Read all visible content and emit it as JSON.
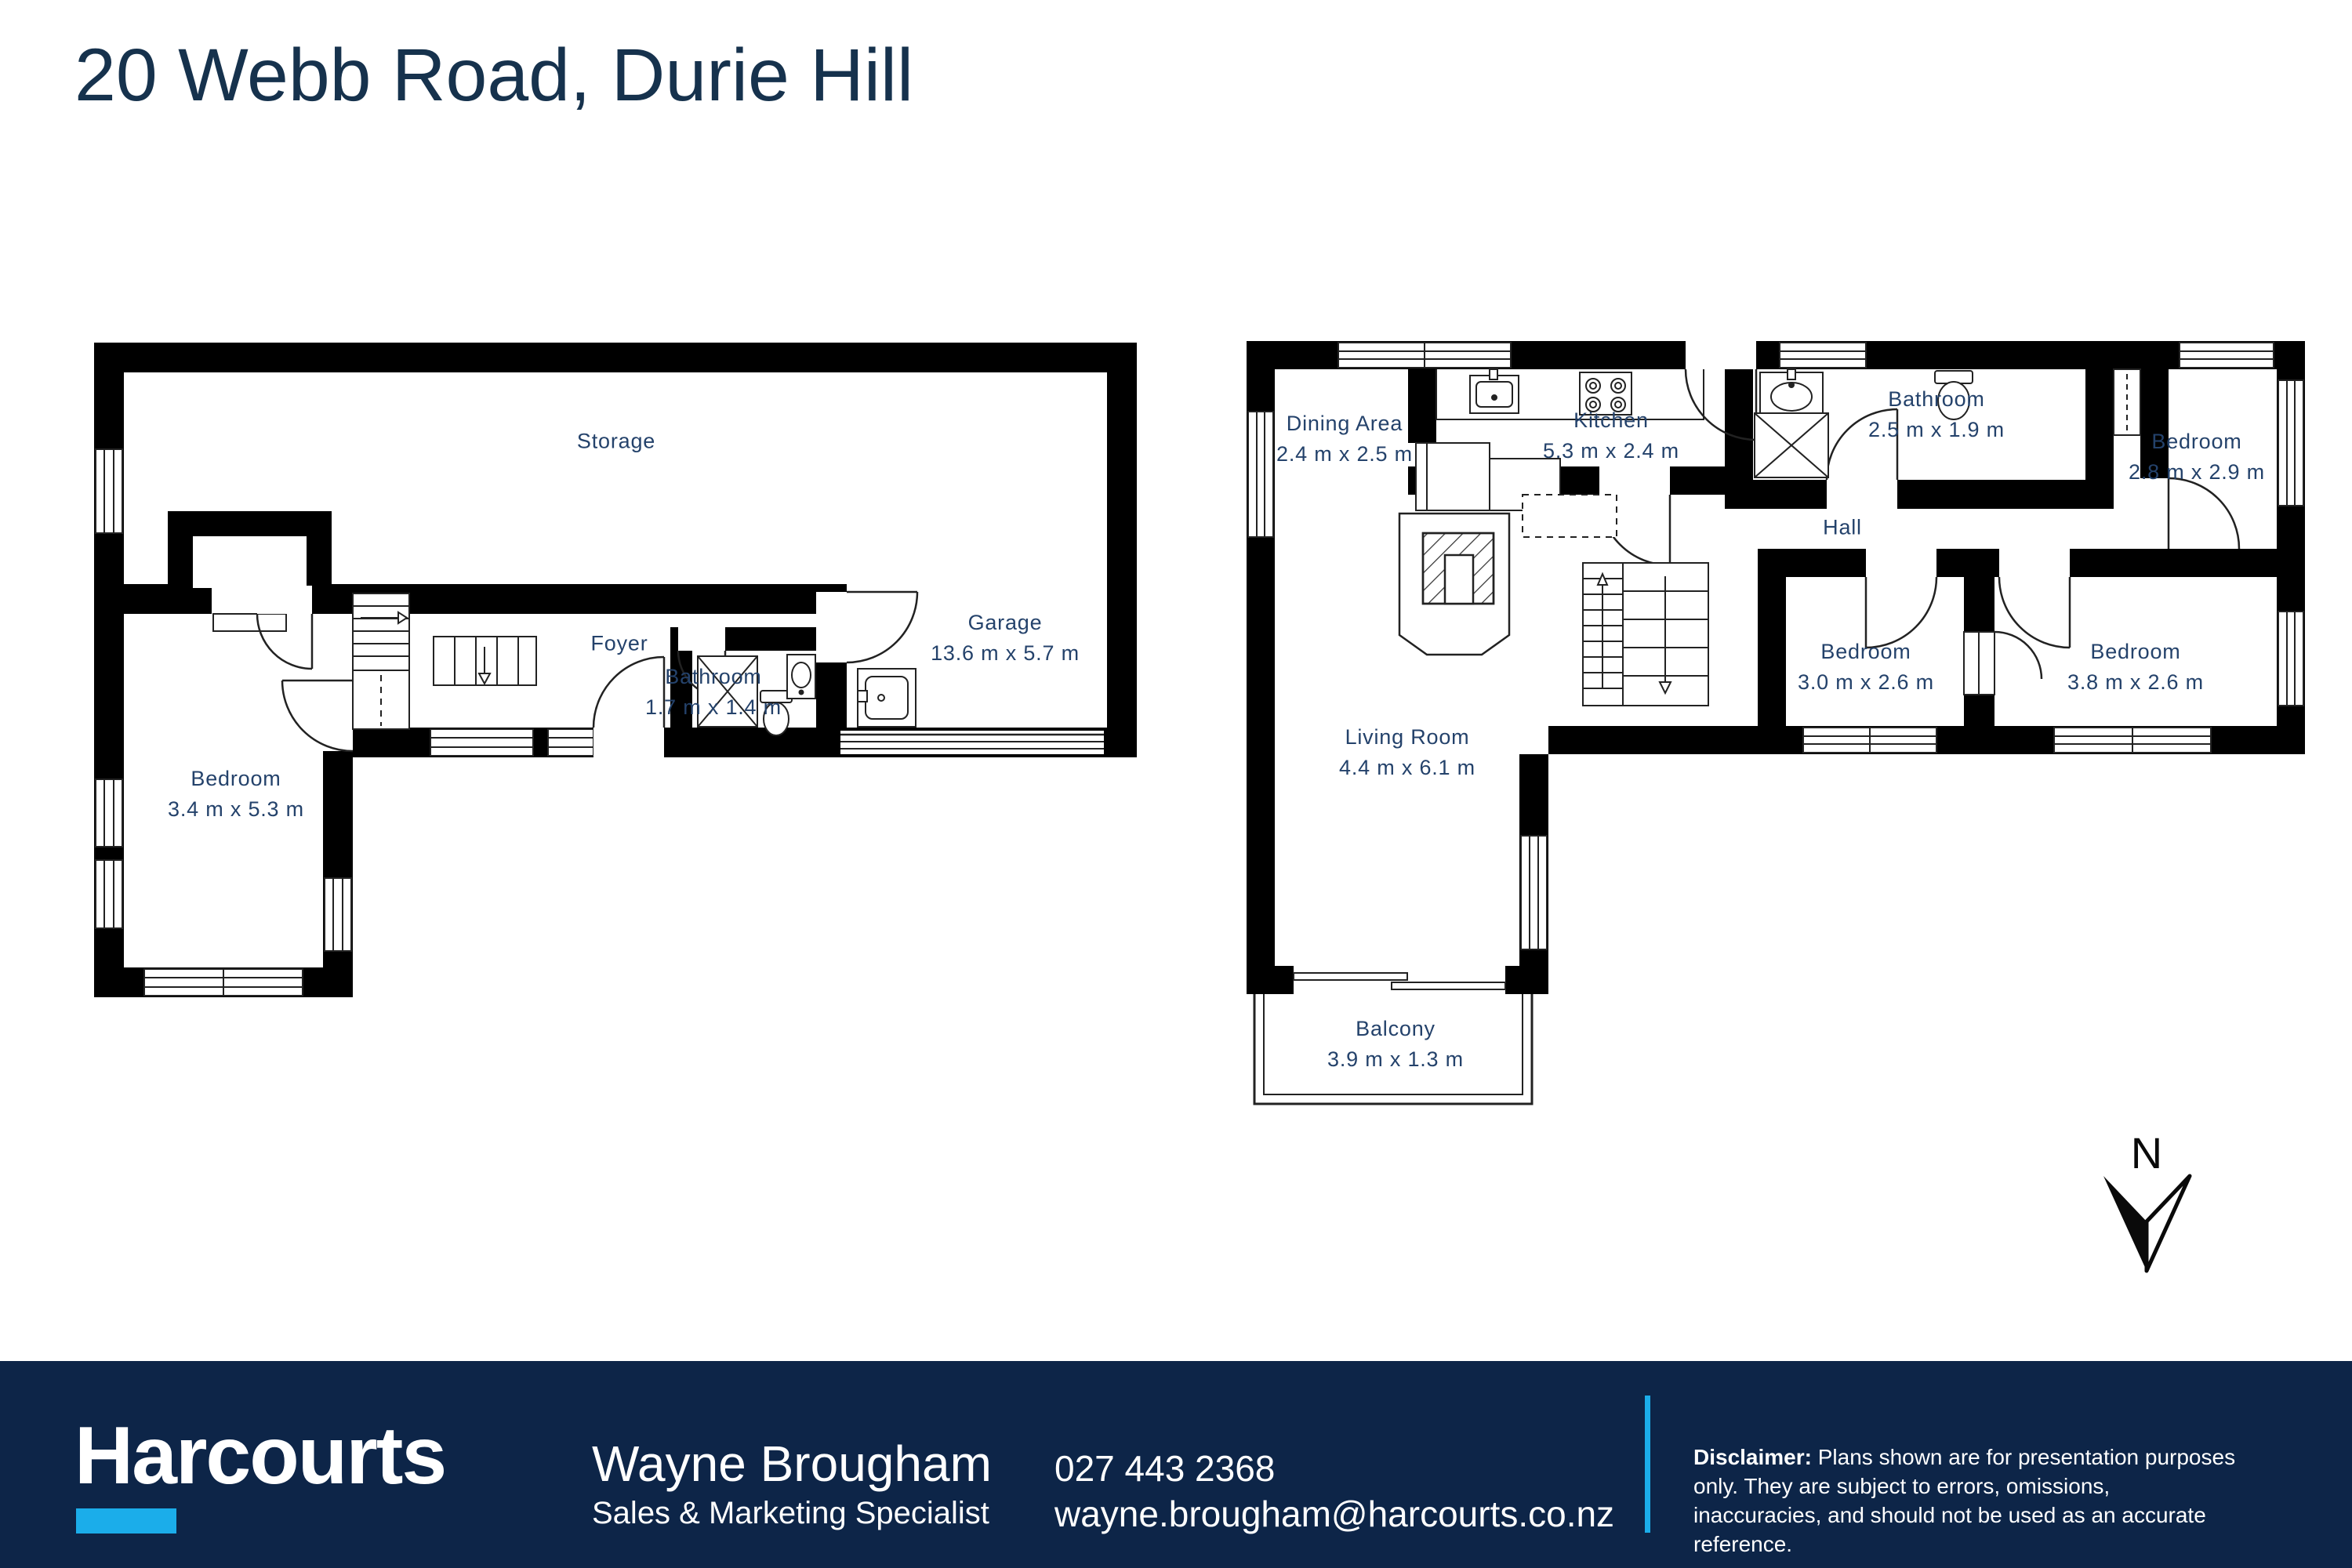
{
  "page": {
    "title": "20 Webb Road, Durie Hill"
  },
  "floor_plans": {
    "ground_floor": {
      "rooms": [
        {
          "name": "Storage",
          "dims": ""
        },
        {
          "name": "Foyer",
          "dims": ""
        },
        {
          "name": "Bathroom",
          "dims": "1.7 m x 1.4 m"
        },
        {
          "name": "Garage",
          "dims": "13.6 m x 5.7 m"
        },
        {
          "name": "Bedroom",
          "dims": "3.4 m x 5.3 m"
        }
      ]
    },
    "upper_floor": {
      "rooms": [
        {
          "name": "Dining Area",
          "dims": "2.4 m x 2.5 m"
        },
        {
          "name": "Kitchen",
          "dims": "5.3 m x 2.4 m"
        },
        {
          "name": "Bathroom",
          "dims": "2.5 m x 1.9 m"
        },
        {
          "name": "Bedroom",
          "dims": "2.8 m x 2.9 m"
        },
        {
          "name": "Hall",
          "dims": ""
        },
        {
          "name": "Bedroom",
          "dims": "3.0 m x 2.6 m"
        },
        {
          "name": "Bedroom",
          "dims": "3.8 m x 2.6 m"
        },
        {
          "name": "Living Room",
          "dims": "4.4 m x 6.1 m"
        },
        {
          "name": "Balcony",
          "dims": "3.9 m x 1.3 m"
        }
      ]
    }
  },
  "compass": {
    "label": "N"
  },
  "footer": {
    "brand": "Harcourts",
    "agent_name": "Wayne Brougham",
    "agent_title": "Sales & Marketing Specialist",
    "phone": "027 443 2368",
    "email": "wayne.brougham@harcourts.co.nz",
    "disclaimer_label": "Disclaimer:",
    "disclaimer_text": " Plans shown are for presentation purposes only.  They are subject to errors, omissions, inaccuracies, and should not be used as an accurate reference."
  },
  "colors": {
    "accent_cyan": "#1badea",
    "footer_bg": "#0d2548",
    "label_navy": "#24426b",
    "title_navy": "#16324d",
    "wall_black": "#000000"
  }
}
